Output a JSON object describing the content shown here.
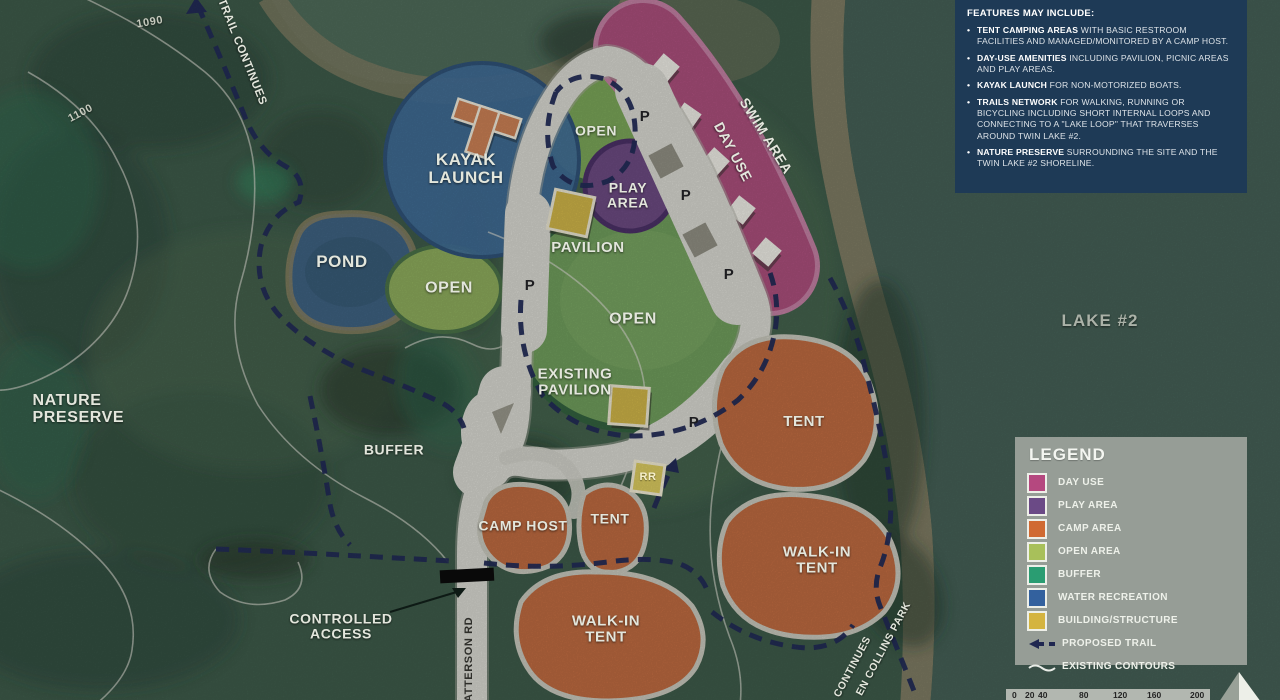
{
  "colors": {
    "day_use": "#b5487f",
    "play_area": "#6b4a86",
    "camp_area": "#d06a32",
    "open_area": "#a8c05a",
    "buffer": "#2a9d72",
    "water_recreation": "#33619e",
    "building_structure": "#d4b440",
    "proposed_trail": "#232c56",
    "road": "#d7d7d0",
    "features_panel_bg": "#1e3a56",
    "legend_panel_bg": "#99a099"
  },
  "icons": {
    "proposed_trail": "dashed-arrow-left",
    "existing_contours": "wavy-line",
    "north": "north-arrow-triangle"
  },
  "features_panel": {
    "title": "FEATURES MAY INCLUDE:",
    "bullets": [
      {
        "lead": "TENT CAMPING AREAS",
        "rest": " WITH BASIC RESTROOM FACILITIES AND MANAGED/MONITORED BY A CAMP HOST."
      },
      {
        "lead": "DAY-USE AMENITIES",
        "rest": " INCLUDING PAVILION, PICNIC AREAS AND PLAY AREAS."
      },
      {
        "lead": "KAYAK LAUNCH",
        "rest": " FOR NON-MOTORIZED BOATS."
      },
      {
        "lead": "TRAILS NETWORK",
        "rest": " FOR WALKING, RUNNING OR BICYCLING INCLUDING SHORT INTERNAL LOOPS AND CONNECTING TO A \"LAKE LOOP\" THAT TRAVERSES AROUND TWIN LAKE #2."
      },
      {
        "lead": "NATURE PRESERVE",
        "rest": " SURROUNDING THE SITE AND THE TWIN LAKE #2 SHORELINE."
      }
    ]
  },
  "legend": {
    "title": "LEGEND",
    "items": [
      {
        "label": "DAY USE",
        "color": "#b5487f"
      },
      {
        "label": "PLAY AREA",
        "color": "#6b4a86"
      },
      {
        "label": "CAMP AREA",
        "color": "#d06a32"
      },
      {
        "label": "OPEN AREA",
        "color": "#a8c05a"
      },
      {
        "label": "BUFFER",
        "color": "#2a9d72"
      },
      {
        "label": "WATER RECREATION",
        "color": "#33619e"
      },
      {
        "label": "BUILDING/STRUCTURE",
        "color": "#d4b440"
      }
    ],
    "proposed_trail_label": "PROPOSED TRAIL",
    "existing_contours_label": "EXISTING CONTOURS"
  },
  "scale_bar": {
    "ticks": [
      "0",
      "20",
      "40",
      "80",
      "120",
      "160",
      "200"
    ]
  },
  "map": {
    "labels": {
      "c1090": "1090",
      "c1100": "1100",
      "trail_continues": "TRAIL CONTINUES",
      "pond": "POND",
      "kayak_launch": "KAYAK LAUNCH",
      "open": "OPEN",
      "play_area": "PLAY AREA",
      "pavilion": "PAVILION",
      "existing_pavilion": "EXISTING PAVILION",
      "swim_area": "SWIM AREA",
      "day_use": "DAY USE",
      "lake2": "LAKE #2",
      "nature_preserve": "NATURE PRESERVE",
      "buffer": "BUFFER",
      "camp_host": "CAMP HOST",
      "tent": "TENT",
      "walk_in_tent": "WALK-IN TENT",
      "controlled_access": "CONTROLLED ACCESS",
      "patterson_rd": "PATTERSON RD",
      "continues": "CONTINUES",
      "collins_park": "EN COLLINS PARK",
      "parking": "P",
      "restroom": "RR"
    }
  }
}
